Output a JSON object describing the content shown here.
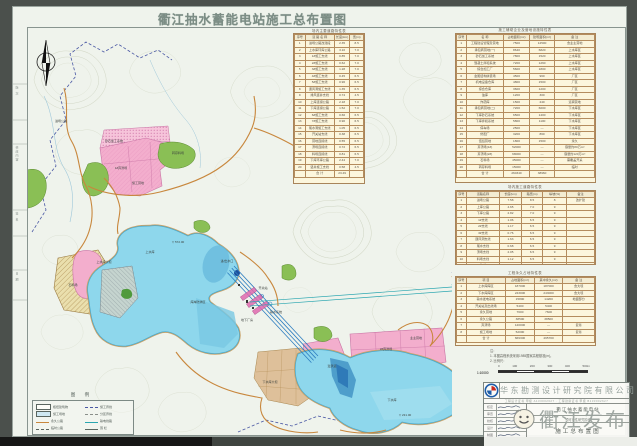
{
  "title": "衢江抽水蓄能电站施工总布置图",
  "watermark": {
    "text": "衢江发布",
    "emoji": "emoji-face-icon"
  },
  "colors": {
    "water": "#8ed7ec",
    "spoil_pink": "#f3aecd",
    "green_area": "#8abf55",
    "quarry_yellow": "#eadfad",
    "road_orange": "#c8873d",
    "boundary_blue": "#4a58a4",
    "tunnel_blue": "#2d7dc0",
    "table_cream": "#fcf6dd"
  },
  "center_table": {
    "title": "场内主要道路特性表",
    "headers": [
      "序号",
      "道 路 名 称",
      "长度(km)",
      "宽(m)"
    ],
    "rows": [
      [
        "1",
        "进场公路改建段",
        "2.35",
        "8.5"
      ],
      [
        "2",
        "上水库环库公路",
        "3.10",
        "7.0"
      ],
      [
        "3",
        "1#施工支线",
        "0.85",
        "7.0"
      ],
      [
        "4",
        "2#施工支线",
        "0.62",
        "7.0"
      ],
      [
        "5",
        "3#施工支线",
        "1.28",
        "7.0"
      ],
      [
        "6",
        "4#施工支线",
        "0.45",
        "6.5"
      ],
      [
        "7",
        "5#施工支线",
        "0.96",
        "6.5"
      ],
      [
        "8",
        "通风洞施工支线",
        "1.35",
        "6.5"
      ],
      [
        "9",
        "排风竖井支线",
        "0.74",
        "4.5"
      ],
      [
        "10",
        "上库连接公路",
        "2.18",
        "7.0"
      ],
      [
        "11",
        "下库连接公路",
        "1.52",
        "7.0"
      ],
      [
        "12",
        "6#施工支线",
        "0.66",
        "6.5"
      ],
      [
        "13",
        "7#施工支线",
        "0.90",
        "6.5"
      ],
      [
        "14",
        "尾水洞施工支线",
        "1.05",
        "6.5"
      ],
      [
        "15",
        "开关站支线",
        "0.38",
        "6.5"
      ],
      [
        "16",
        "营地连接线",
        "0.55",
        "6.5"
      ],
      [
        "17",
        "渣场连接线",
        "0.72",
        "6.5"
      ],
      [
        "18",
        "料场连接线",
        "0.81",
        "6.5"
      ],
      [
        "19",
        "下库环库公路",
        "2.44",
        "7.0"
      ],
      [
        "20",
        "竖井施工支线",
        "0.58",
        "4.5"
      ],
      [
        "",
        "合 计",
        "23.49",
        ""
      ]
    ]
  },
  "right_table_1": {
    "title": "施工辅助企业及营地设施特性表",
    "headers": [
      "序号",
      "名  称",
      "占地面积(m²)",
      "建筑面积(m²)",
      "备  注"
    ],
    "rows": [
      [
        "1",
        "工程建设管理及营地",
        "7500",
        "12500",
        "含业主营地"
      ],
      [
        "2",
        "承包商营地(一)",
        "8640",
        "6820",
        "上水库区"
      ],
      [
        "3",
        "砂石加工系统",
        "7800",
        "1520",
        "上水库区"
      ],
      [
        "4",
        "混凝土拌和系统",
        "7200",
        "1260",
        "上水库区"
      ],
      [
        "5",
        "综合加工厂",
        "5600",
        "1800",
        "上水库区"
      ],
      [
        "6",
        "金属结构拼装场",
        "4500",
        "960",
        "厂区"
      ],
      [
        "7",
        "机电设备仓库",
        "4800",
        "1500",
        "厂区"
      ],
      [
        "8",
        "综合仓库",
        "3600",
        "1200",
        "厂区"
      ],
      [
        "9",
        "油库",
        "1200",
        "300",
        "厂区"
      ],
      [
        "10",
        "炸药库",
        "1500",
        "240",
        "远离营地"
      ],
      [
        "11",
        "承包商营地(二)",
        "7200",
        "6000",
        "下水库区"
      ],
      [
        "12",
        "下库砂石系统",
        "6500",
        "1400",
        "下水库区"
      ],
      [
        "13",
        "下库拌和系统",
        "5800",
        "1100",
        "下水库区"
      ],
      [
        "14",
        "停车场",
        "2500",
        "—",
        "下水库区"
      ],
      [
        "15",
        "修配厂",
        "3200",
        "860",
        "下水库区"
      ],
      [
        "16",
        "值班营地",
        "1800",
        "1500",
        "永久"
      ],
      [
        "17",
        "弃渣场(1#)",
        "52000",
        "—",
        "容量约80万m³"
      ],
      [
        "18",
        "弃渣场(2#)",
        "68000",
        "—",
        "容量约120万m³"
      ],
      [
        "19",
        "石料场",
        "45000",
        "—",
        "需覆盖开采"
      ],
      [
        "20",
        "转存料场",
        "15000",
        "—",
        "临时"
      ],
      [
        "",
        "合 计",
        "260340",
        "38960",
        ""
      ]
    ]
  },
  "right_table_2": {
    "title": "场内施工道路特性表",
    "headers": [
      "序号",
      "道路名称",
      "长度(km)",
      "路宽(m)",
      "纵坡(%)",
      "备注"
    ],
    "rows": [
      [
        "1",
        "进场公路",
        "7.58",
        "8.5",
        "8",
        "改扩建"
      ],
      [
        "2",
        "上库公路",
        "4.65",
        "7.0",
        "9",
        ""
      ],
      [
        "3",
        "下库公路",
        "2.82",
        "7.0",
        "9",
        ""
      ],
      [
        "4",
        "1#支线",
        "1.06",
        "6.5",
        "9",
        ""
      ],
      [
        "5",
        "2#支线",
        "1.17",
        "6.5",
        "9",
        ""
      ],
      [
        "6",
        "3#支线",
        "0.76",
        "6.5",
        "9",
        ""
      ],
      [
        "7",
        "通风洞支线",
        "1.63",
        "6.5",
        "9",
        ""
      ],
      [
        "8",
        "尾水支线",
        "0.68",
        "6.5",
        "9",
        ""
      ],
      [
        "9",
        "渣场支线",
        "2.05",
        "6.5",
        "9",
        ""
      ],
      [
        "10",
        "料场支线",
        "1.12",
        "6.5",
        "9",
        ""
      ],
      [
        "",
        "合 计",
        "23.52",
        "",
        "",
        ""
      ]
    ]
  },
  "right_table_3": {
    "title": "工程永久占地特性表",
    "headers": [
      "序号",
      "项  目",
      "占地面积(m²)",
      "其中永久(m²)",
      "备 注"
    ],
    "rows": [
      [
        "1",
        "上水库库区",
        "187000",
        "187000",
        "含大坝"
      ],
      [
        "2",
        "下水库库区",
        "243000",
        "243000",
        "含大坝"
      ],
      [
        "3",
        "输水发电系统",
        "15800",
        "14200",
        "地面部分"
      ],
      [
        "4",
        "开关站及出线场",
        "5400",
        "5400",
        ""
      ],
      [
        "5",
        "永久营地",
        "7600",
        "7600",
        ""
      ],
      [
        "6",
        "永久公路",
        "38500",
        "38500",
        ""
      ],
      [
        "7",
        "弃渣场",
        "120000",
        "—",
        "复垦"
      ],
      [
        "8",
        "施工场地",
        "52000",
        "—",
        "复垦"
      ],
      [
        "",
        "合 计",
        "669300",
        "495700",
        ""
      ]
    ]
  },
  "notes": [
    "注：",
    "1. 本图高程系统采用1985国家高程基准(m)。",
    "2. 比例尺："
  ],
  "scale": {
    "ratio": "1:10000",
    "ticks": [
      "0",
      "100",
      "200",
      "300",
      "400",
      "500m"
    ]
  },
  "legend": {
    "title": "图  例",
    "left": [
      {
        "sym": "rect",
        "label": "枢纽建筑物"
      },
      {
        "sym": "rect2",
        "label": "施工场地"
      },
      {
        "sym": "road",
        "label": "永久公路"
      },
      {
        "sym": "droad",
        "label": "临时公路"
      }
    ],
    "right": [
      {
        "sym": "dash",
        "label": "施工界线"
      },
      {
        "sym": "dashdot",
        "label": "分区界线"
      },
      {
        "sym": "ticks",
        "label": "输电线路"
      },
      {
        "sym": "line",
        "label": "围  栏"
      }
    ]
  },
  "map_labels": [
    {
      "t": "上水库",
      "x": 150,
      "y": 252
    },
    {
      "t": "上水库大坝",
      "x": 104,
      "y": 262
    },
    {
      "t": "库岸防渗区",
      "x": 198,
      "y": 302
    },
    {
      "t": "进/出水口",
      "x": 227,
      "y": 261
    },
    {
      "t": "输水系统",
      "x": 276,
      "y": 312
    },
    {
      "t": "地下厂房",
      "x": 247,
      "y": 320
    },
    {
      "t": "开关站",
      "x": 263,
      "y": 288
    },
    {
      "t": "下水库",
      "x": 392,
      "y": 400
    },
    {
      "t": "下水库大坝",
      "x": 270,
      "y": 382
    },
    {
      "t": "溢洪道",
      "x": 332,
      "y": 366
    },
    {
      "t": "1#弃渣场",
      "x": 121,
      "y": 168
    },
    {
      "t": "施工营地",
      "x": 138,
      "y": 183
    },
    {
      "t": "砂石加工系统",
      "x": 114,
      "y": 141
    },
    {
      "t": "2#弃渣场",
      "x": 386,
      "y": 349
    },
    {
      "t": "业主营地",
      "x": 416,
      "y": 338
    },
    {
      "t": "石料场",
      "x": 73,
      "y": 285
    },
    {
      "t": "转存料场",
      "x": 178,
      "y": 153
    },
    {
      "t": "进场公路",
      "x": 61,
      "y": 121
    },
    {
      "t": "▽ 572.00",
      "x": 178,
      "y": 242
    },
    {
      "t": "▽ 231.00",
      "x": 405,
      "y": 415
    }
  ],
  "left_strip": [
    {
      "t": "版 次",
      "y": 86
    },
    {
      "t": "修改内容",
      "y": 146
    },
    {
      "t": "签 名",
      "y": 212
    },
    {
      "t": "日 期",
      "y": 272
    }
  ],
  "titleblock": {
    "company": "华东勘测设计研究院有限公司",
    "cert": "工程设计证书 甲级 A133002627 · 工程勘察证书 甲级 B133002627",
    "sig_labels": [
      "核定",
      "审查",
      "校核",
      "设计",
      "制图"
    ],
    "project": "衢江抽水蓄能电站",
    "stage": "预可行性研究阶段",
    "drawing": "施工总布置图",
    "meta": [
      [
        "图号",
        "4058-NB-05"
      ],
      [
        "比例",
        "1:10000"
      ],
      [
        "日期",
        "2017.06"
      ]
    ]
  }
}
